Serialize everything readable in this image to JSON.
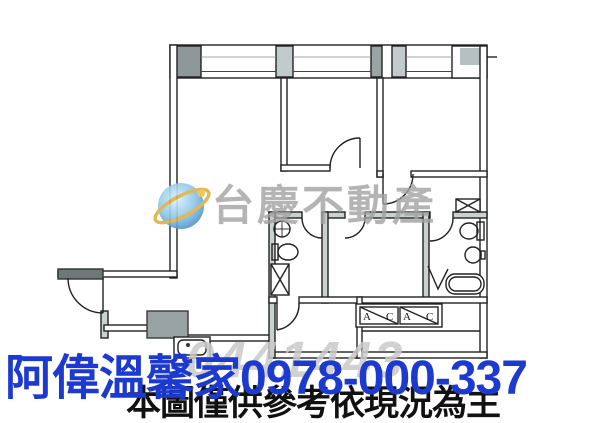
{
  "watermarks": {
    "agency": "台慶不動產",
    "serial": "0441443",
    "caption": "阿偉溫馨家0978-000-337",
    "disclaimer": "本圖僅供參考依現況為主"
  },
  "plan_labels": {
    "ac1_a": "A",
    "ac1_c": "C",
    "ac2_a": "A",
    "ac2_c": "C"
  },
  "colors": {
    "caption_blue": "#1c3ad0",
    "disclaimer_black": "#111111",
    "agency_gray": "#a2a2a2",
    "serial_gray": "#c9c9c9",
    "wall_ink": "#222222",
    "column_gray": "#8e9898",
    "logo_blue": "#5da4d8",
    "logo_yellow": "#dfb143"
  }
}
